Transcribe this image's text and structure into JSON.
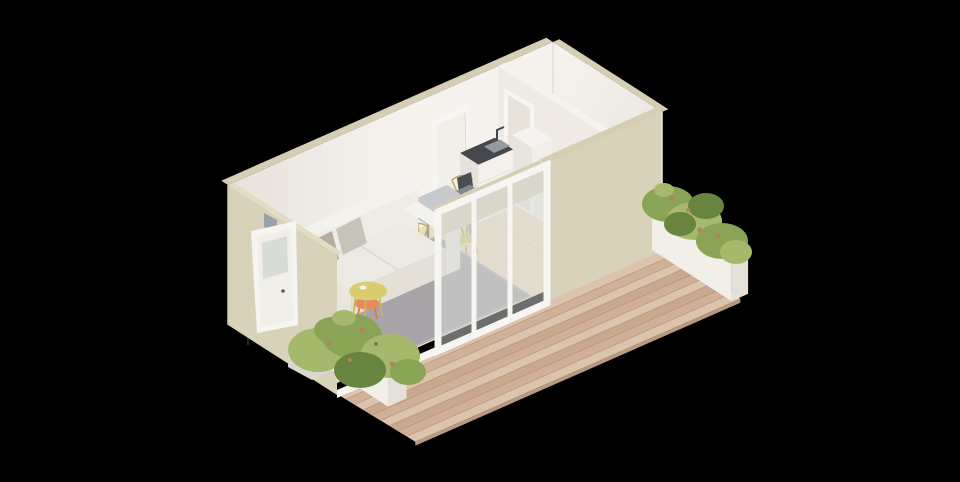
{
  "scene": {
    "title": "isometric-tiny-home-render",
    "rooms": [
      "living-kitchen-dining",
      "bedroom"
    ],
    "objects": [
      "two-seat-sofa",
      "throw-pillows",
      "area-rug",
      "round-coffee-table",
      "nesting-side-table",
      "dining-table",
      "dining-chair",
      "laptop",
      "kitchen-counter-with-sink",
      "refrigerator",
      "interior-door",
      "bedroom-doorway",
      "front-door",
      "sliding-glass-door",
      "wood-deck",
      "planter-box",
      "shrub-plant",
      "entry-step"
    ],
    "counts": {
      "dining_chairs": 4,
      "pillows": 2,
      "planters": 2,
      "plants": 2
    }
  },
  "palette": {
    "bg": "#000000",
    "wallBeige": "#d8d2bb",
    "wallBeigeDark": "#cfc8ae",
    "wallBeigeLine": "#d0c9b0",
    "wallTopStrip": "#d5cdb4",
    "wallTopLight": "#e2dcc5",
    "cornerLight": "#e6dfc8",
    "intWallLight": "#f6f3ee",
    "intWallMid": "#efebe4",
    "intWallShade": "#e7e2da",
    "intWallDark": "#ddd8cf",
    "floorWood": "#ecdcc2",
    "floorWoodLine": "#dfcdaf",
    "floorWhite": "#f3f1ed",
    "deckPlankA": "#dcc3ac",
    "deckPlankB": "#d0b096",
    "deckPlankC": "#c9a88e",
    "deckLine": "#b2947c",
    "deckEdge": "#b89a83",
    "rug": "#a9a4a7",
    "rugEdge": "#b6b1b4",
    "sofaBody": "#efece6",
    "sofaTop": "#f4f2ed",
    "sofaShade": "#ddd8d0",
    "sofaFront": "#e9e6df",
    "sofaSeat": "#eceae3",
    "sofaSeatFront": "#e4e0d8",
    "sofaLine": "#d8d4ca",
    "pillowDark": "#b2aca3",
    "pillowLight": "#c8c3b9",
    "tableYellow": "#d9cd6f",
    "tableYellowDark": "#c6ba5c",
    "tableOrange": "#e58b5c",
    "tableOrangeDark": "#d57a4b",
    "chairYellow": "#d5c97b",
    "chairYellowDark": "#b9ac60",
    "diningTop": "#c6cacd",
    "diningEdge": "#b0b4b8",
    "diningLeg": "#9ea2a6",
    "laptopDark": "#4a4e52",
    "laptopBase": "#85898d",
    "counterWhite": "#f4f1ec",
    "counterShade": "#e6e2db",
    "counterTop": "#44484c",
    "sink": "#939ba0",
    "fridgeTop": "#f6f4f0",
    "fridgeSide": "#e8e4de",
    "fridgeFront": "#f1ede7",
    "doorWhite": "#f7f5f1",
    "doorPanel": "#f2efe9",
    "glass": "#d7dcd9",
    "handle": "#5a5e62",
    "planterWhite": "#f2efe9",
    "planterShade": "#e5e1da",
    "planterTop": "#f7f5f0",
    "plantGreen": "#8aa455",
    "plantGreenLight": "#a5b96d",
    "plantGreenDark": "#67853f",
    "plantRust": "#b5825f",
    "stepTop": "#eceae4",
    "stepSide": "#dcd8d0",
    "shadowBlue": "#9aa0a8"
  }
}
